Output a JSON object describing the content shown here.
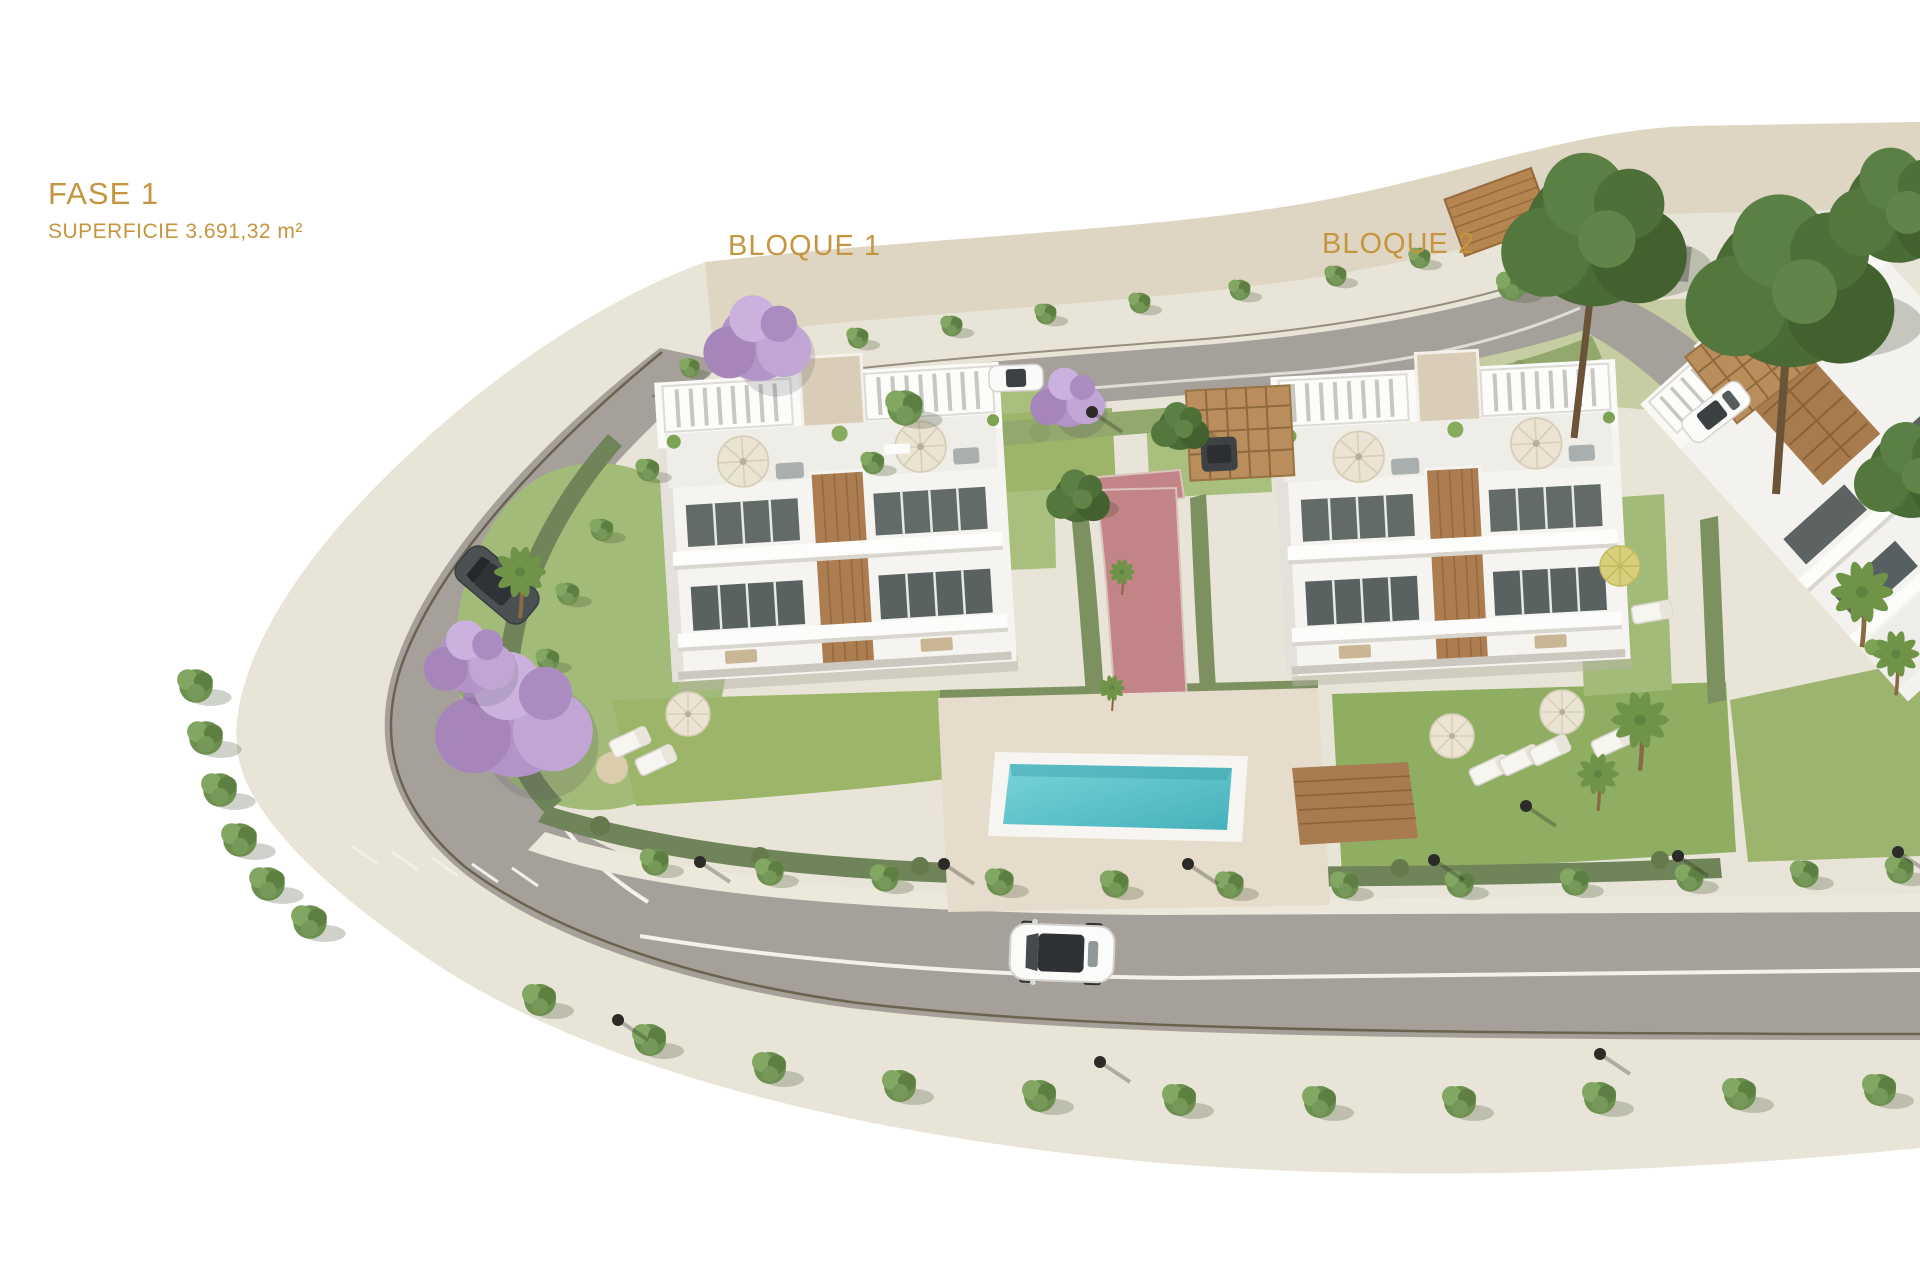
{
  "header": {
    "phase_label": "FASE 1",
    "surface_label": "SUPERFICIE 3.691,32 m²"
  },
  "blocks": [
    {
      "label": "BLOQUE 1"
    },
    {
      "label": "BLOQUE 2"
    }
  ],
  "colors": {
    "label_gold": "#c6953f",
    "ground_beige": "#e9e4d8",
    "road_gray": "#a5a19a",
    "lawn_green": "#a3bb78",
    "hedge_green": "#70845a",
    "pool_turquoise": "#5cc5cd",
    "path_rose": "#c28487",
    "wood_brown": "#ab7d51",
    "building_white": "#f5f4f1",
    "jacaranda_purple": "#b394c8"
  },
  "scene": {
    "type": "architectural-site-render",
    "objects": [
      "apartment-block-1",
      "apartment-block-2",
      "partial-block-3",
      "swimming-pool",
      "wood-deck",
      "perimeter-road",
      "pedestrian-path",
      "street-trees",
      "jacaranda-trees",
      "palm-trees",
      "cars",
      "carports",
      "street-lamps",
      "sun-loungers",
      "parasols"
    ]
  }
}
